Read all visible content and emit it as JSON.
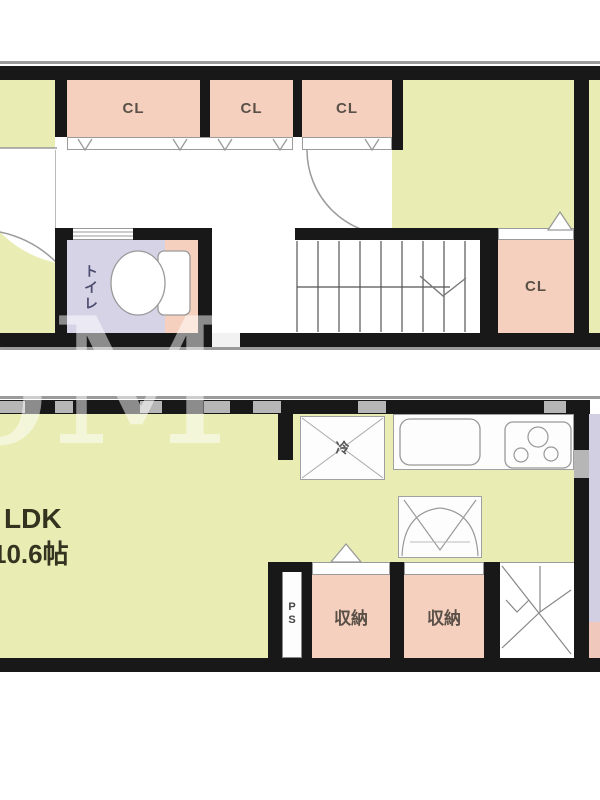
{
  "upper": {
    "closets": [
      {
        "label": "CL"
      },
      {
        "label": "CL"
      },
      {
        "label": "CL"
      },
      {
        "label": "CL"
      }
    ],
    "toilet_label": "トイレ"
  },
  "lower": {
    "ldk_name": "LDK",
    "ldk_size": "10.6帖",
    "fridge": "冷",
    "ps": "PS",
    "storages": [
      {
        "label": "収納"
      },
      {
        "label": "収納"
      }
    ]
  },
  "watermark": "oM",
  "colors": {
    "room_fill": "#e9edb4",
    "closet_fill": "#f6d0bf",
    "toilet_fill": "#d6d3e6",
    "wall": "#181818",
    "outside_right": "#d2cfe2",
    "outside_right_pink": "#f0c8bc"
  }
}
